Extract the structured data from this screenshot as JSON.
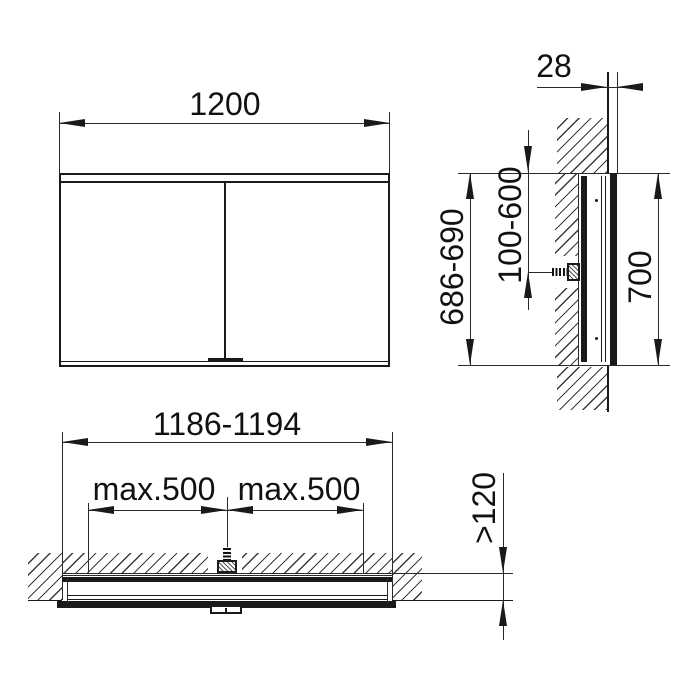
{
  "drawing": {
    "type_label": "mirror-cabinet-recessed-installation-drawing",
    "colors": {
      "line": "#1a1a1a",
      "background": "#ffffff"
    }
  },
  "front_view": {
    "width_label": "1200"
  },
  "side_view": {
    "protrusion_label": "28",
    "recess_height_label": "686-690",
    "fixing_range_label": "100-600",
    "cabinet_height_label": "700"
  },
  "bottom_view": {
    "recess_width_label": "1186-1194",
    "fixing_spacing_left_label": "max.500",
    "fixing_spacing_right_label": "max.500",
    "recess_depth_label": "&gt;120"
  }
}
